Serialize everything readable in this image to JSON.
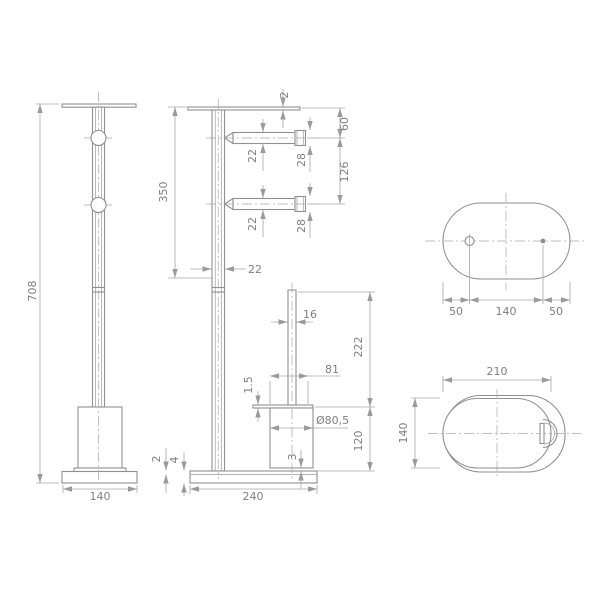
{
  "drawing": {
    "type": "technical-dimension-drawing",
    "views": {
      "front": {
        "overall_height": "708",
        "base_width": "140"
      },
      "side": {
        "top_plate_thickness": "2",
        "upper_section_height": "350",
        "top_arm_offset": "60",
        "arm_diameter_1": "22",
        "cap_diameter_1": "28",
        "arm_spacing": "126",
        "arm_diameter_2": "22",
        "cap_diameter_2": "28",
        "pole_diameter": "22",
        "post_diameter": "16",
        "drop_height": "222",
        "lid_width": "81",
        "lid_thickness": "1.5",
        "cup_diameter": "Ø80,5",
        "cup_height": "120",
        "bottom_gap": "3",
        "base_lip_thickness": "2",
        "base_plate_thickness": "4",
        "base_length": "240"
      },
      "top": {
        "left_hole_offset": "50",
        "hole_spacing": "140",
        "right_hole_offset": "50"
      },
      "detail": {
        "plate_width": "210",
        "plate_depth": "140"
      }
    },
    "colors": {
      "outline": "#8f8f8f",
      "dimension": "#a6a6a6",
      "text": "#7f7f7f",
      "background": "#ffffff"
    }
  }
}
